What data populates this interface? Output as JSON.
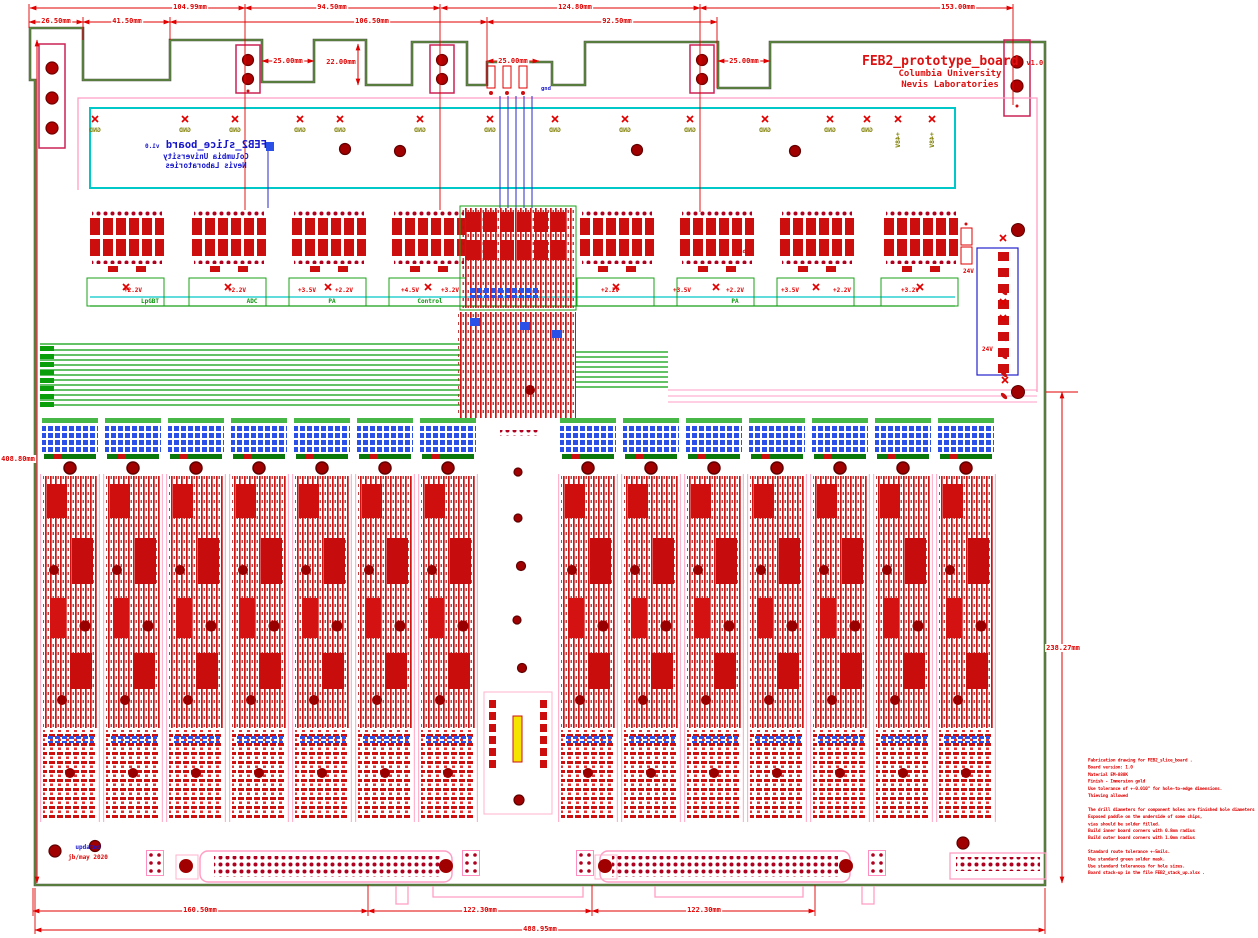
{
  "title_block": {
    "board_name": "FEB2_prototype_board",
    "version": "v1.0",
    "org": "Columbia University",
    "lab": "Nevis Laboratories"
  },
  "back_silkscreen": {
    "board_name": "FEB2_slice_board",
    "version": "v1.0",
    "org": "Columbia University",
    "lab": "Nevis Laboratories"
  },
  "revision_note": {
    "status": "updated",
    "author_date": "jb/may 2020"
  },
  "net_labels": {
    "gnd": "GND",
    "p48v": "+48V",
    "v24": "24V",
    "gnd_small": "gnd"
  },
  "section_labels": [
    "LpGBT",
    "ADC",
    "PA",
    "Control"
  ],
  "voltage_labels": [
    "+2.2V",
    "+2.2V",
    "+3.5V",
    "+2.2V",
    "+4.5V",
    "+3.2V",
    "+2.2V",
    "+3.5V",
    "+2.2V",
    "+3.5V",
    "+2.2V",
    "+3.2V"
  ],
  "dimensions": [
    "104.99mm",
    "94.50mm",
    "124.80mm",
    "153.00mm",
    "26.50mm",
    "41.50mm",
    "106.50mm",
    "92.50mm",
    "25.00mm",
    "22.00mm",
    "25.00mm",
    "25.00mm",
    "408.80mm",
    "238.27mm",
    "160.50mm",
    "122.30mm",
    "122.30mm",
    "488.95mm"
  ],
  "fabrication_notes": {
    "lines": [
      "Fabrication drawing for FEB2_slice_board .",
      "Board version: 1.0",
      "Material EM-888K",
      "Finish - Immersion gold",
      "Use tolerance of +-0.010\" for hole-to-edge dimensions.",
      "Thieving allowed",
      "",
      "The drill diameters for component holes are finished hole diameters",
      "Exposed paddle on the underside of some chips,",
      "vias should be solder filled.",
      "Build inner board corners with 0.8mm radius",
      "Build outer board corners with 1.0mm radius",
      "",
      "Standard route tolerance +-5mils.",
      "Use standard green solder mask.",
      "Use standard tolerances for hole sizes.",
      "Board stack-up in the file FEB2_stack_up.xlsx ."
    ]
  },
  "colors": {
    "dimension_red": "#e00000",
    "title_red": "#dd1111",
    "silk_blue": "#1515cc",
    "net_olive": "#7f7f00",
    "board_edge_green": "#5a9e32",
    "board_edge_dark": "#55584a",
    "cyan": "#00c8c8",
    "pad_red": "#cc0e0e",
    "pad_blue": "#2a50e8",
    "hole_dark_red": "#990000",
    "trace_green": "#0b9e0b",
    "outline_pink": "#ff9ec4",
    "section_green": "#0a930a"
  }
}
